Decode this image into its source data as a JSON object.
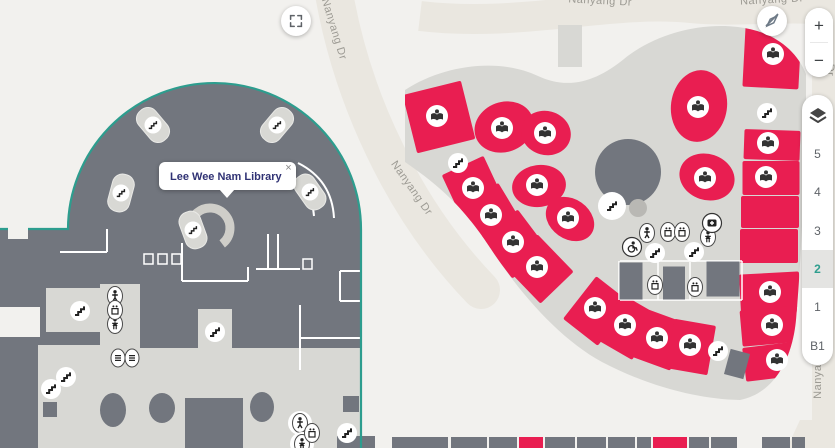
{
  "tooltip": {
    "title": "Lee Wee Nam Library",
    "close": "×"
  },
  "controls": {
    "zoom_in": "+",
    "zoom_out": "−",
    "floors": [
      "5",
      "4",
      "3",
      "2",
      "1",
      "B1"
    ],
    "active_floor": "2",
    "fullscreen_icon": "expand-icon",
    "compass_icon": "compass-disabled-icon",
    "layers_icon": "layers-icon"
  },
  "colors": {
    "background": "#f2f1ee",
    "road": "#eae7e0",
    "building_light": "#d8d8d4",
    "building_dark": "#72767e",
    "room_red": "#e91e51",
    "selected_outline": "#2d9d8e",
    "icon_dark": "#333333",
    "label_gray": "#9c9a93",
    "tooltip_text": "#303274",
    "floor_active": "#2f9e8e"
  },
  "street_labels": [
    {
      "text": "Nanyang Dr",
      "x": 331,
      "y": 30,
      "rot": 73
    },
    {
      "text": "Nanyang Dr",
      "x": 409,
      "y": 190,
      "rot": 55
    },
    {
      "text": "Nanyang Dr",
      "x": 600,
      "y": 4,
      "rot": 3
    },
    {
      "text": "Nanyang Dr",
      "x": 772,
      "y": 3,
      "rot": -3
    },
    {
      "text": "Dr",
      "x": 827,
      "y": 70,
      "rot": 90
    },
    {
      "text": "Nanyang Dr",
      "x": 821,
      "y": 367,
      "rot": -90
    }
  ],
  "map_features": {
    "books": [
      [
        437,
        116
      ],
      [
        473,
        188
      ],
      [
        491,
        215
      ],
      [
        513,
        242
      ],
      [
        537,
        267
      ],
      [
        502,
        128
      ],
      [
        545,
        133
      ],
      [
        537,
        185
      ],
      [
        568,
        218
      ],
      [
        698,
        107
      ],
      [
        705,
        178
      ],
      [
        773,
        54
      ],
      [
        768,
        143
      ],
      [
        766,
        177
      ],
      [
        595,
        308
      ],
      [
        625,
        325
      ],
      [
        657,
        338
      ],
      [
        690,
        345
      ],
      [
        770,
        292
      ],
      [
        772,
        325
      ],
      [
        777,
        360
      ]
    ],
    "stairs": [
      [
        458,
        163
      ],
      [
        767,
        113
      ],
      [
        718,
        351
      ],
      [
        612,
        206
      ],
      [
        655,
        253
      ],
      [
        694,
        252
      ],
      [
        80,
        311
      ],
      [
        66,
        377
      ],
      [
        51,
        389
      ],
      [
        215,
        332
      ],
      [
        347,
        433
      ]
    ],
    "stairs_badges": [
      [
        153,
        125,
        -40
      ],
      [
        277,
        125,
        40
      ],
      [
        121,
        193,
        15
      ],
      [
        310,
        192,
        -35
      ],
      [
        193,
        230,
        -20
      ]
    ],
    "restroom_male": [
      [
        115,
        296
      ],
      [
        647,
        233
      ],
      [
        300,
        423
      ]
    ],
    "restroom_female": [
      [
        115,
        324
      ],
      [
        708,
        237
      ],
      [
        302,
        444
      ]
    ],
    "elevators": [
      [
        115,
        310
      ],
      [
        668,
        232
      ],
      [
        682,
        232
      ],
      [
        655,
        285
      ],
      [
        695,
        287
      ],
      [
        312,
        433
      ]
    ],
    "wheelchair": [
      [
        632,
        247
      ]
    ],
    "first_aid": [
      [
        712,
        223
      ]
    ],
    "escalators": [
      [
        118,
        358
      ],
      [
        132,
        358
      ]
    ]
  },
  "red_rooms": {
    "rects": [
      {
        "x": 439,
        "y": 117,
        "w": 60,
        "h": 60,
        "rot": -14
      },
      {
        "x": 474,
        "y": 190,
        "w": 46,
        "h": 54,
        "rot": -25
      },
      {
        "x": 492,
        "y": 217,
        "w": 46,
        "h": 52,
        "rot": -31
      },
      {
        "x": 515,
        "y": 244,
        "w": 46,
        "h": 52,
        "rot": -37
      },
      {
        "x": 539,
        "y": 269,
        "w": 46,
        "h": 52,
        "rot": -44
      },
      {
        "x": 597,
        "y": 311,
        "w": 44,
        "h": 54,
        "rot": 38
      },
      {
        "x": 627,
        "y": 327,
        "w": 42,
        "h": 52,
        "rot": 30
      },
      {
        "x": 659,
        "y": 340,
        "w": 42,
        "h": 50,
        "rot": 20
      },
      {
        "x": 691,
        "y": 347,
        "w": 42,
        "h": 50,
        "rot": 10
      },
      {
        "x": 772,
        "y": 57,
        "w": 56,
        "h": 62,
        "rot": 3
      },
      {
        "x": 772,
        "y": 145,
        "w": 56,
        "h": 30,
        "rot": 2
      },
      {
        "x": 771,
        "y": 178,
        "w": 57,
        "h": 34,
        "rot": 0
      },
      {
        "x": 770,
        "y": 212,
        "w": 58,
        "h": 32,
        "rot": 0
      },
      {
        "x": 769,
        "y": 246,
        "w": 58,
        "h": 34,
        "rot": 0
      },
      {
        "x": 770,
        "y": 293,
        "w": 60,
        "h": 40,
        "rot": -3
      },
      {
        "x": 772,
        "y": 326,
        "w": 62,
        "h": 36,
        "rot": -5
      },
      {
        "x": 776,
        "y": 361,
        "w": 64,
        "h": 34,
        "rot": -7
      }
    ],
    "ellipses": [
      {
        "x": 504,
        "y": 127,
        "rx": 30,
        "ry": 25,
        "rot": -20
      },
      {
        "x": 546,
        "y": 133,
        "rx": 25,
        "ry": 22,
        "rot": 15
      },
      {
        "x": 539,
        "y": 186,
        "rx": 27,
        "ry": 21,
        "rot": -8
      },
      {
        "x": 570,
        "y": 219,
        "rx": 26,
        "ry": 20,
        "rot": 35
      },
      {
        "x": 699,
        "y": 106,
        "rx": 28,
        "ry": 36,
        "rot": 8
      },
      {
        "x": 707,
        "y": 177,
        "rx": 28,
        "ry": 23,
        "rot": 18
      }
    ]
  },
  "gray_rooms": [
    {
      "x": 631,
      "y": 281,
      "w": 23,
      "h": 37,
      "rot": 0
    },
    {
      "x": 674,
      "y": 283,
      "w": 22,
      "h": 33,
      "rot": 0
    },
    {
      "x": 723,
      "y": 279,
      "w": 33,
      "h": 35,
      "rot": 0
    },
    {
      "x": 737,
      "y": 364,
      "w": 20,
      "h": 26,
      "rot": 15
    }
  ],
  "bottom_rooms": [
    {
      "x": 392,
      "w": 56,
      "red": false
    },
    {
      "x": 451,
      "w": 36,
      "red": false
    },
    {
      "x": 489,
      "w": 28,
      "red": false
    },
    {
      "x": 519,
      "w": 24,
      "red": true
    },
    {
      "x": 545,
      "w": 30,
      "red": false
    },
    {
      "x": 577,
      "w": 29,
      "red": false
    },
    {
      "x": 608,
      "w": 27,
      "red": false
    },
    {
      "x": 637,
      "w": 14,
      "red": false
    },
    {
      "x": 653,
      "w": 34,
      "red": true
    },
    {
      "x": 689,
      "w": 20,
      "red": false
    },
    {
      "x": 711,
      "w": 26,
      "red": false
    },
    {
      "x": 762,
      "w": 28,
      "red": false
    },
    {
      "x": 792,
      "w": 13,
      "red": false
    }
  ]
}
